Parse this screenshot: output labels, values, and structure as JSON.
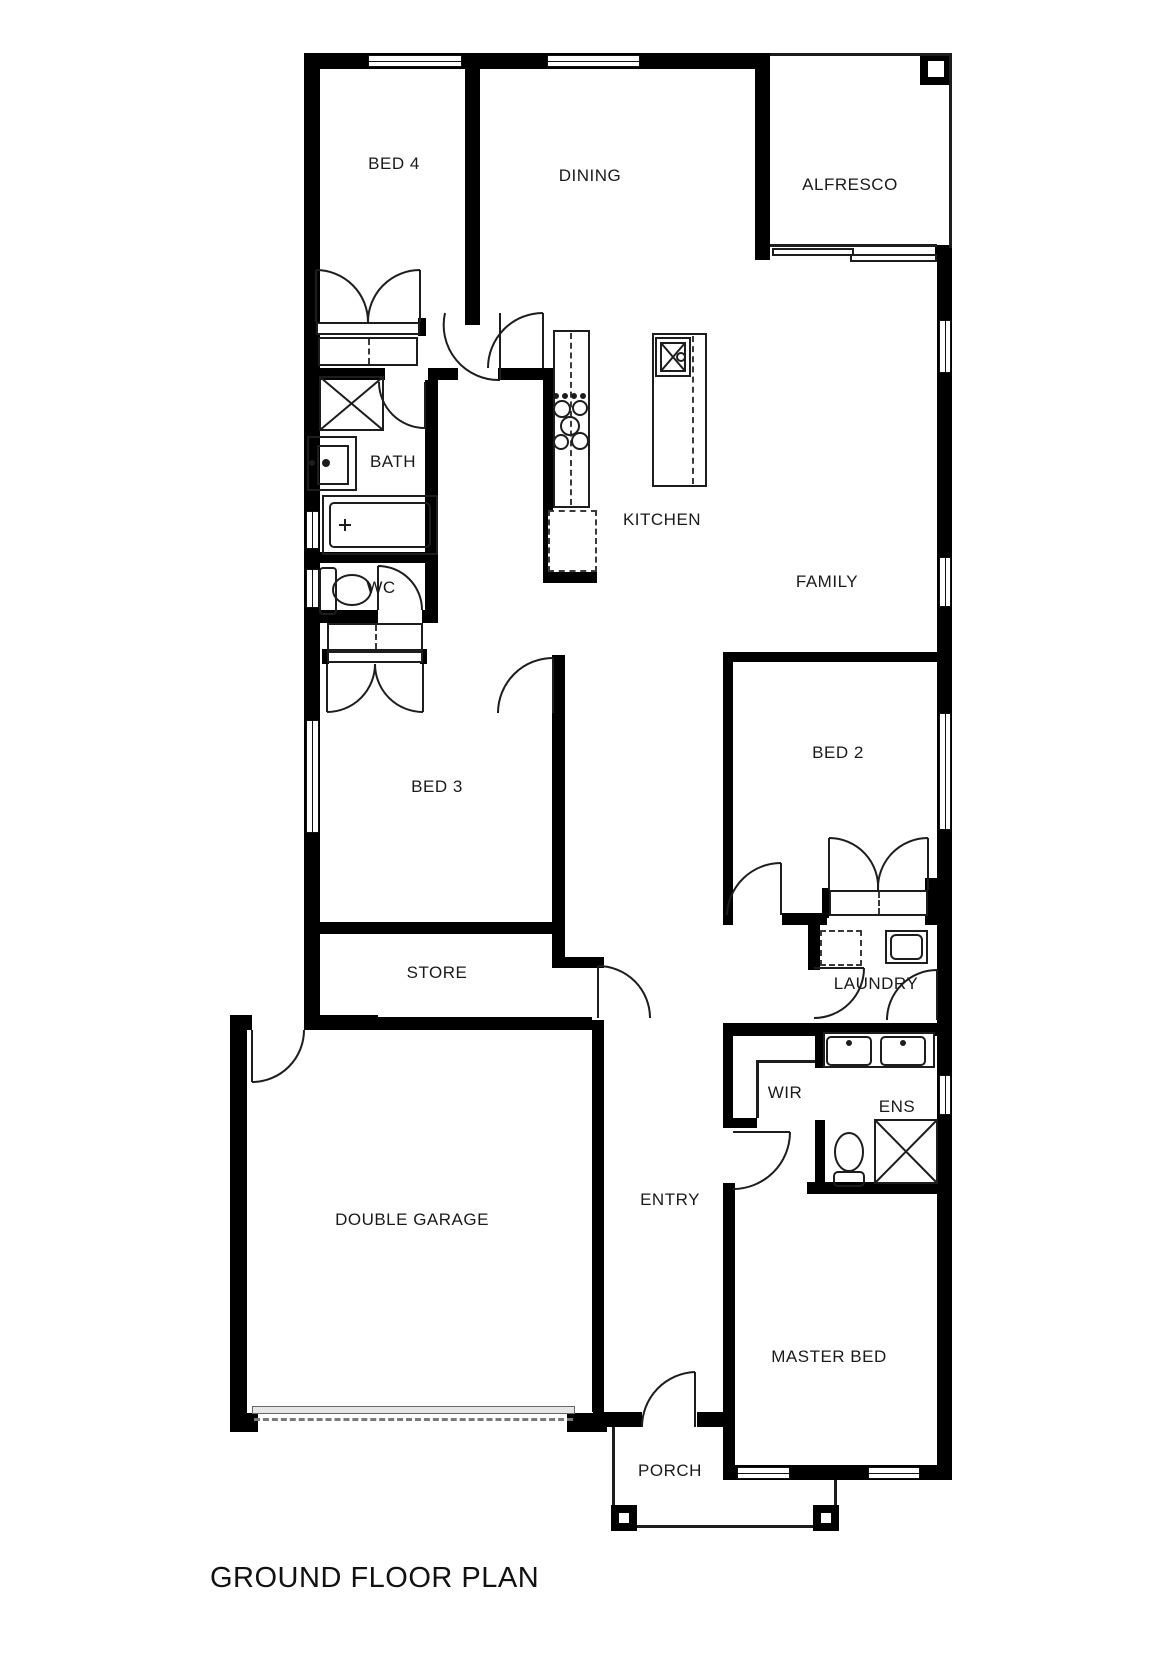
{
  "plan": {
    "title": "GROUND FLOOR PLAN"
  },
  "colors": {
    "wall": "#000000",
    "background": "#ffffff",
    "thin_line": "#1d1d1d"
  },
  "rooms": [
    {
      "id": "bed4",
      "label": "BED 4"
    },
    {
      "id": "dining",
      "label": "DINING"
    },
    {
      "id": "alfresco",
      "label": "ALFRESCO"
    },
    {
      "id": "bath",
      "label": "BATH"
    },
    {
      "id": "kitchen",
      "label": "KITCHEN"
    },
    {
      "id": "wc",
      "label": "WC"
    },
    {
      "id": "family",
      "label": "FAMILY"
    },
    {
      "id": "bed3",
      "label": "BED 3"
    },
    {
      "id": "bed2",
      "label": "BED 2"
    },
    {
      "id": "store",
      "label": "STORE"
    },
    {
      "id": "laundry",
      "label": "LAUNDRY"
    },
    {
      "id": "wir",
      "label": "WIR"
    },
    {
      "id": "ens",
      "label": "ENS"
    },
    {
      "id": "garage",
      "label": "DOUBLE GARAGE"
    },
    {
      "id": "entry",
      "label": "ENTRY"
    },
    {
      "id": "master",
      "label": "MASTER BED"
    },
    {
      "id": "porch",
      "label": "PORCH"
    }
  ]
}
